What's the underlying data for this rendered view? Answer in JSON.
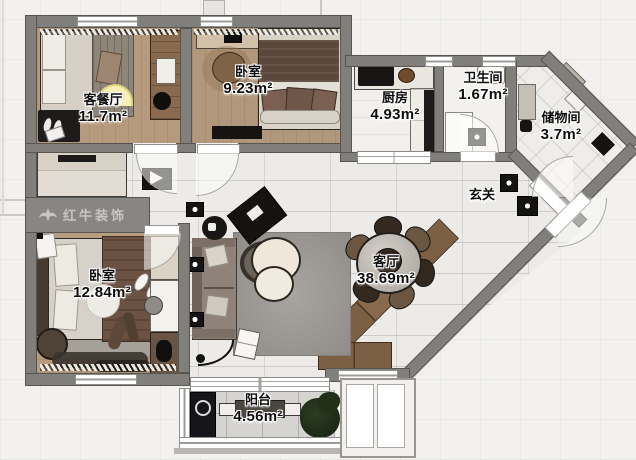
{
  "plan": {
    "type": "apartment-floor-plan",
    "watermark": {
      "brand": "红牛装饰"
    },
    "rooms": [
      {
        "name": "客餐厅",
        "area": "11.7m²"
      },
      {
        "name": "卧室",
        "area": "9.23m²"
      },
      {
        "name": "厨房",
        "area": "4.93m²"
      },
      {
        "name": "卫生间",
        "area": "1.67m²"
      },
      {
        "name": "储物间",
        "area": "3.7m²"
      },
      {
        "name": "玄关",
        "area": ""
      },
      {
        "name": "客厅",
        "area": "38.69m²"
      },
      {
        "name": "卧室",
        "area": "12.84m²"
      },
      {
        "name": "阳台",
        "area": "4.56m²"
      }
    ]
  },
  "colors": {
    "wall": "#807f7c",
    "wood_floor": "#b59a7d",
    "tile_floor": "#ecebe8",
    "balcony_floor": "#d5d4d1",
    "cabinet_wood": "#7d5f43",
    "label_text": "#0d0d0d"
  }
}
